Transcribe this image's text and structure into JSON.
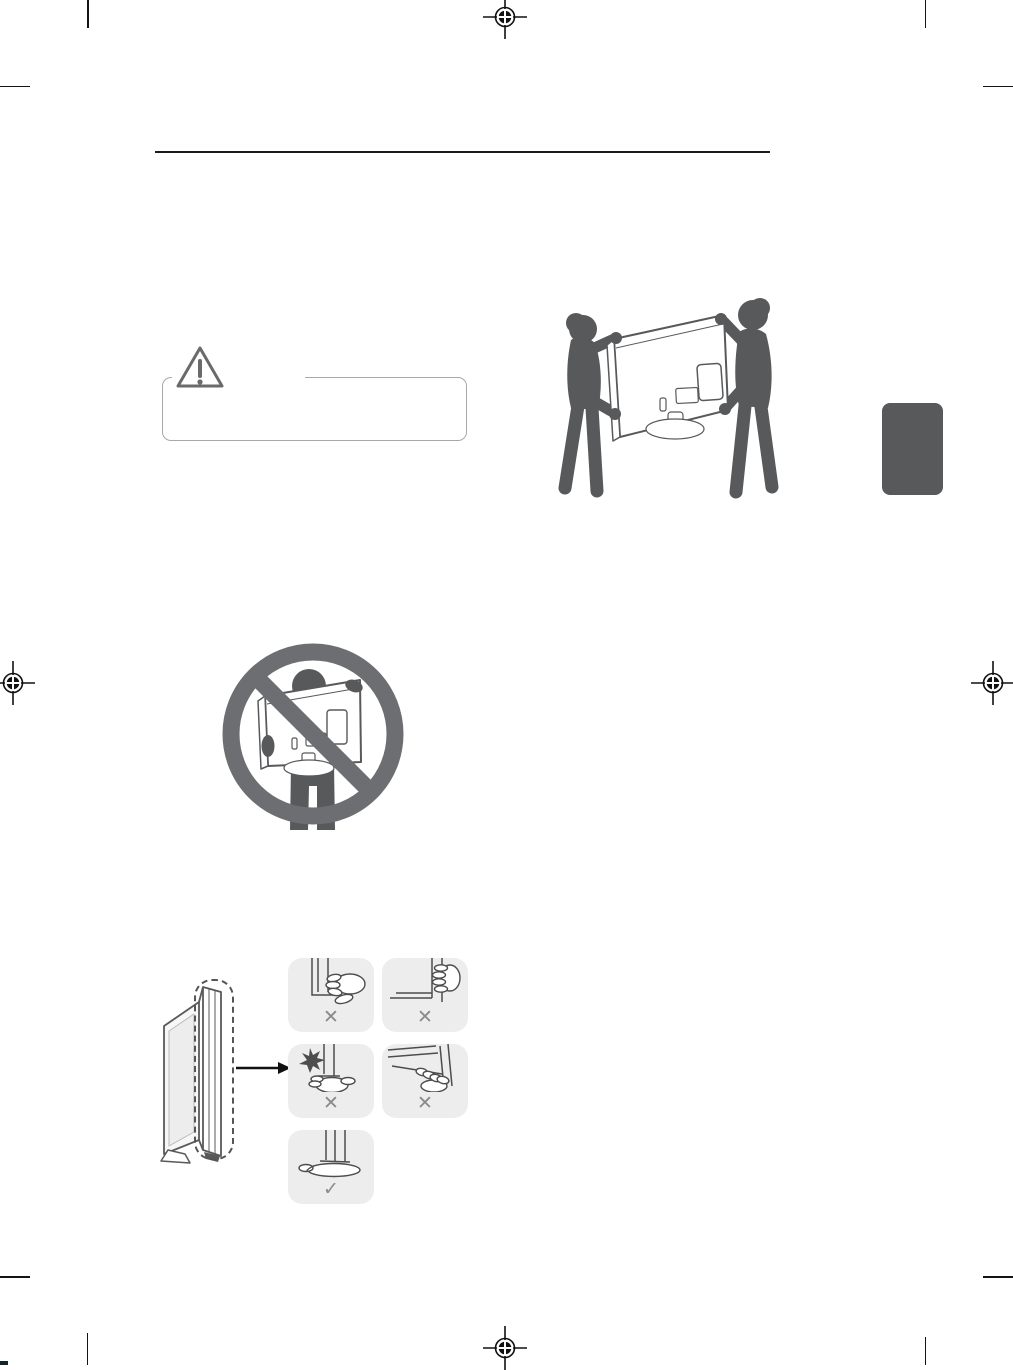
{
  "page": {
    "background": "#ffffff",
    "kind": "printed-manual-page",
    "description": "TV user manual page: lifting and moving instructions (illustrations only; body text not rendered)"
  },
  "header": {
    "rule_color": "#1b1b1b"
  },
  "print_marks": {
    "crop_mark_color": "#141414",
    "registration_mark_color": "#111111",
    "registration_icon": "registration-target-icon"
  },
  "caution_box": {
    "border_color": "#a8a8a8",
    "icon": "warning-triangle-icon",
    "icon_color": "#6a6a6a"
  },
  "section_tab": {
    "color": "#58595b"
  },
  "illustrations": {
    "two_person_carry": {
      "icon": "two-person-carry-tv-illustration",
      "silhouette_color": "#58595b"
    },
    "single_person_prohibited": {
      "icon": "no-single-person-carry-illustration",
      "prohibition_ring_color": "#6d6e71",
      "silhouette_color": "#58595b"
    },
    "panel_grip_guide": {
      "icon": "panel-grip-guide-illustration",
      "tile_background": "#ededed",
      "line_color": "#4d4d4d",
      "verdict_color": "#8a8a8a",
      "tiles": [
        {
          "icon": "grip-front-screen-icon",
          "verdict": "✕"
        },
        {
          "icon": "grip-top-edge-icon",
          "verdict": "✕"
        },
        {
          "icon": "press-screen-impact-icon",
          "verdict": "✕"
        },
        {
          "icon": "grip-bottom-bezel-icon",
          "verdict": "✕"
        },
        {
          "icon": "support-bottom-edge-icon",
          "verdict": "✓"
        }
      ]
    }
  }
}
